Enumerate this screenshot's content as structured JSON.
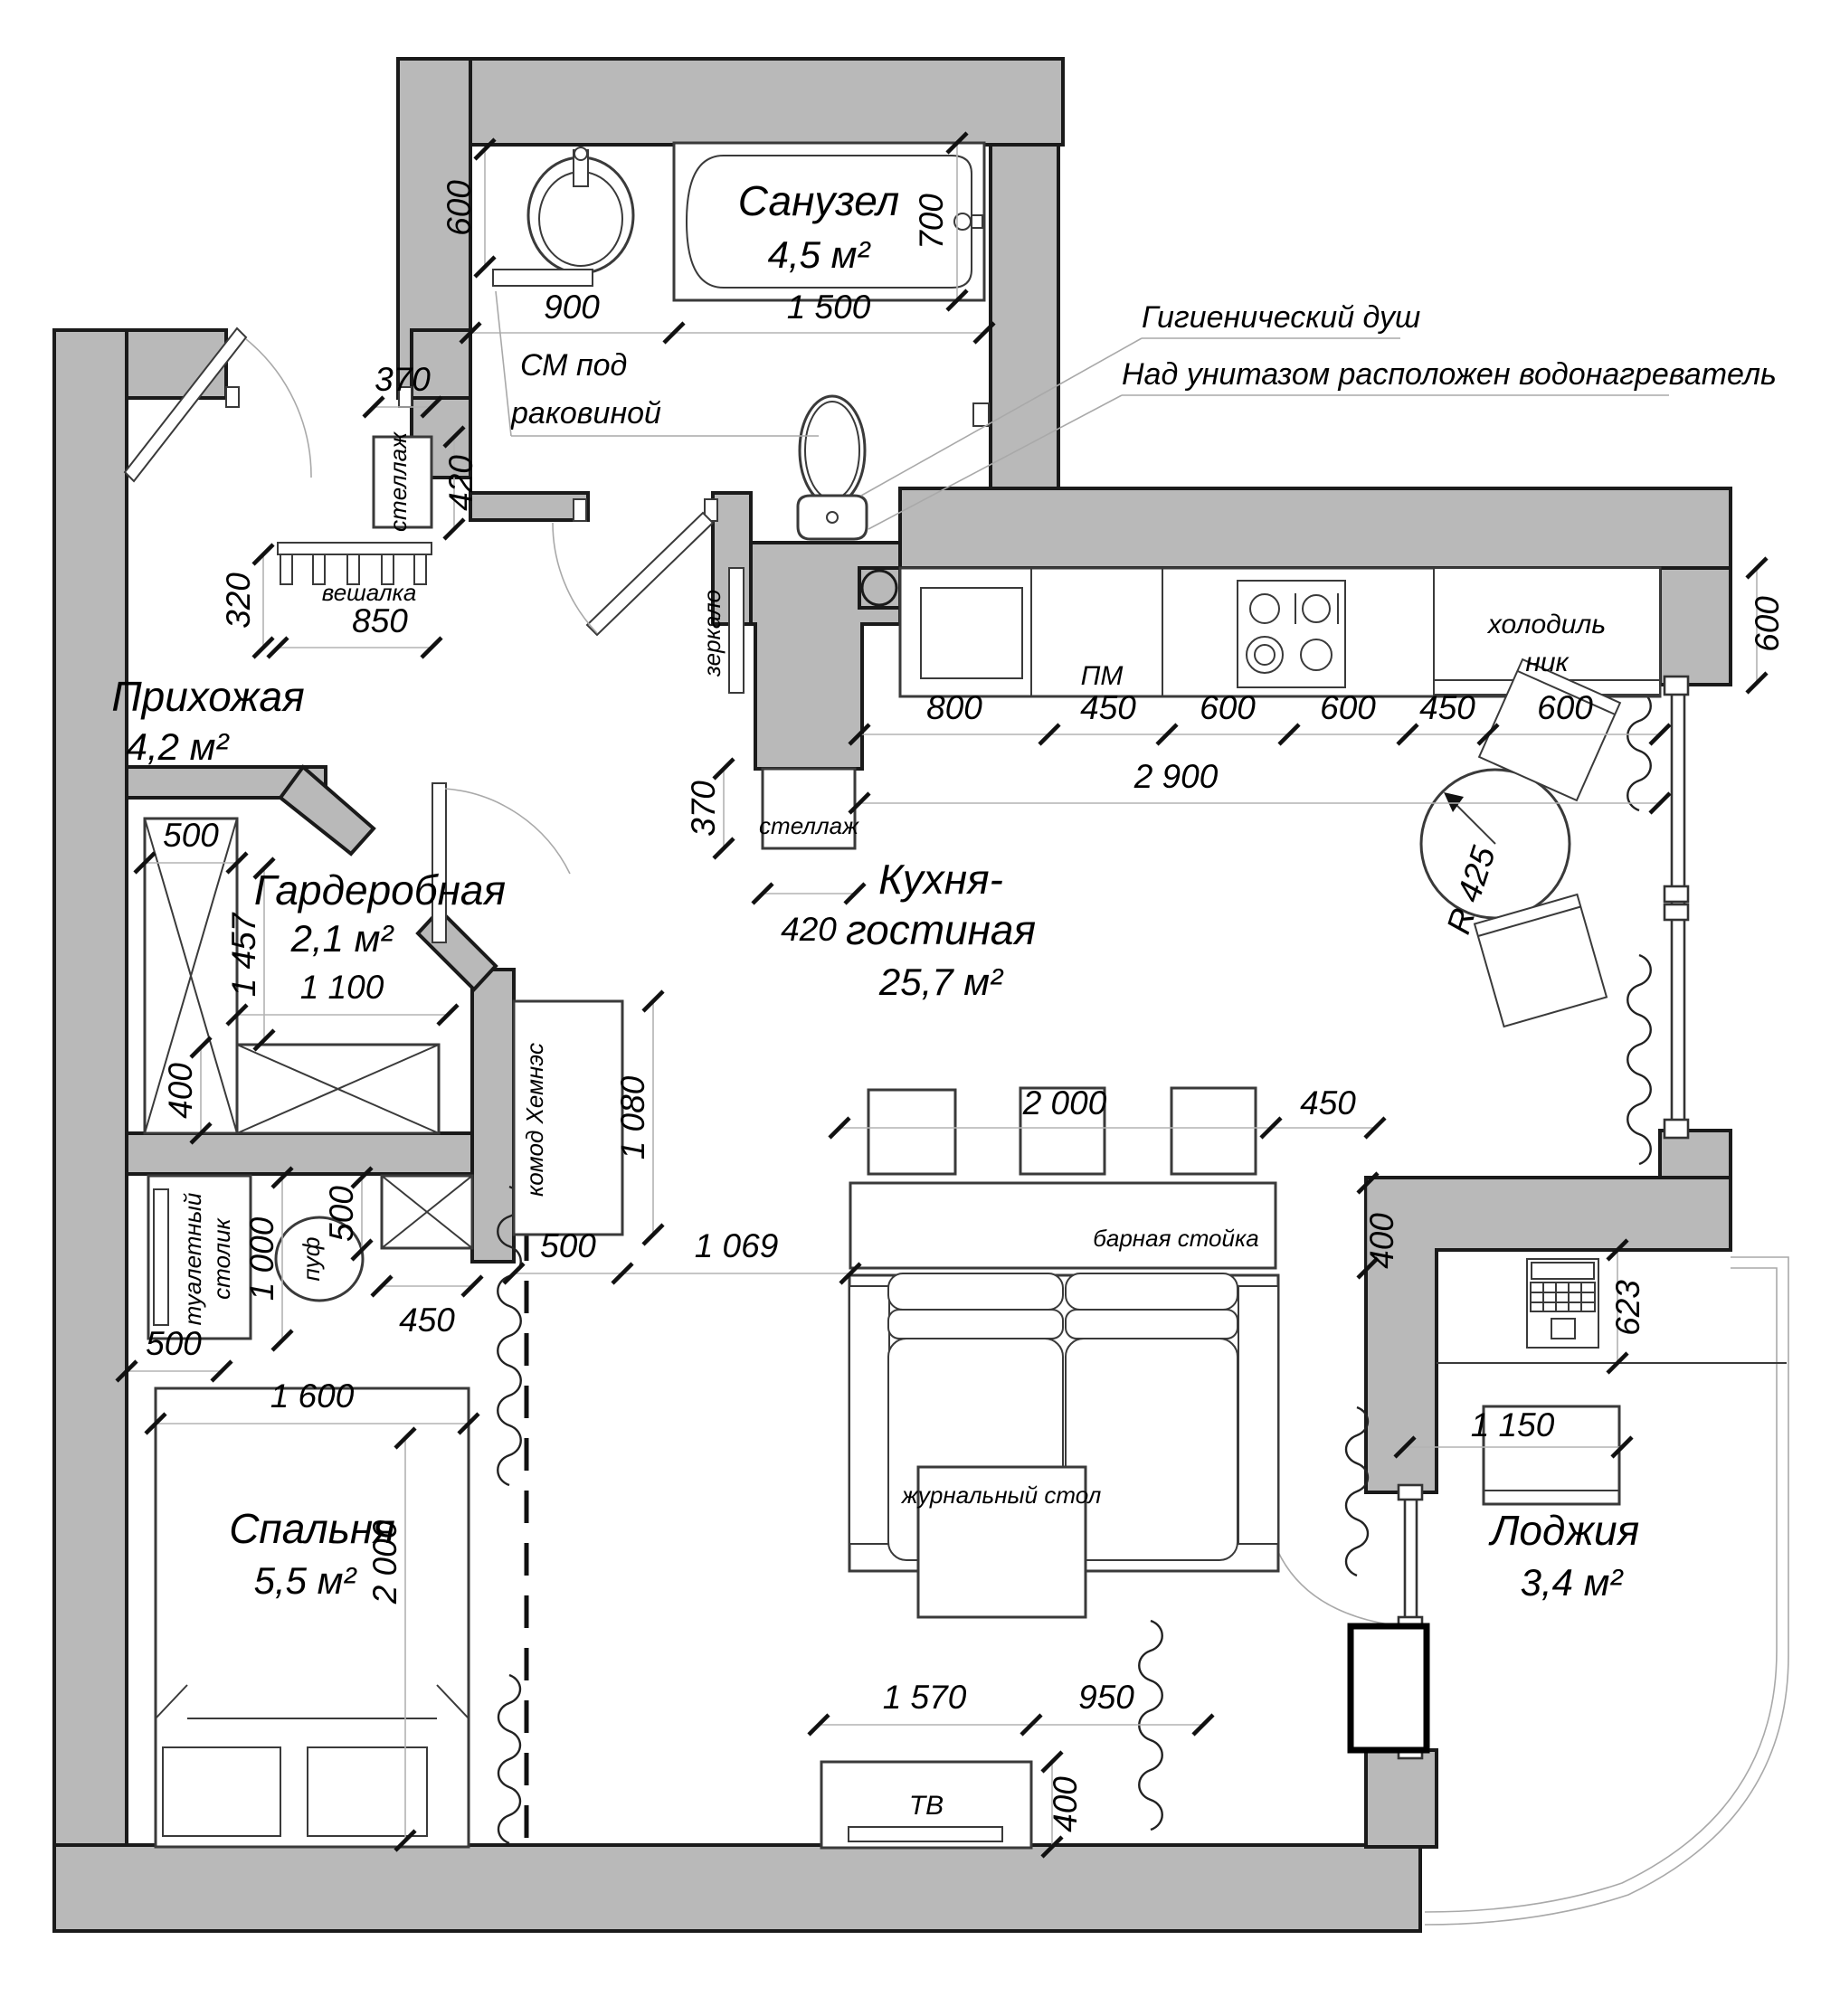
{
  "rooms": {
    "bathroom": {
      "name": "Санузел",
      "area": "4,5 м²"
    },
    "hallway": {
      "name": "Прихожая",
      "area": "4,2 м²"
    },
    "wardrobe": {
      "name": "Гардеробная",
      "area": "2,1 м²"
    },
    "kitchen": {
      "name_line1": "Кухня-",
      "name_line2": "гостиная",
      "area": "25,7 м²"
    },
    "bedroom": {
      "name": "Спальня",
      "area": "5,5 м²"
    },
    "loggia": {
      "name": "Лоджия",
      "area": "3,4 м²"
    }
  },
  "annotations": {
    "shower": "Гигиенический душ",
    "heater": "Над унитазом расположен водонагреватель",
    "washer_line1": "СМ под",
    "washer_line2": "раковиной"
  },
  "furniture": {
    "shelf_hall": "стеллаж",
    "shelf_kitchen": "стеллаж",
    "hanger": "вешалка",
    "mirror": "зеркало",
    "dishwasher": "ПМ",
    "fridge_line1": "холодиль",
    "fridge_line2": "ник",
    "dresser": "комод Хемнэс",
    "dressing_table_line1": "туалетный",
    "dressing_table_line2": "столик",
    "pouf": "пуф",
    "bar": "барная стойка",
    "coffee_table": "журнальный стол",
    "tv": "ТВ",
    "table_radius": "R 425"
  },
  "dims": {
    "bath_600": "600",
    "bath_900": "900",
    "bath_1500": "1 500",
    "bath_700": "700",
    "hall_370": "370",
    "hall_420": "420",
    "hall_320": "320",
    "hall_850": "850",
    "wr_500": "500",
    "wr_1457": "1 457",
    "wr_1100": "1 100",
    "wr_400": "400",
    "dr_1000": "1 000",
    "dr_500": "500",
    "dr_450": "450",
    "dr_500b": "500",
    "bed_1600": "1 600",
    "bed_2000": "2 000",
    "km_1080": "1 080",
    "km_500": "500",
    "km_1069": "1 069",
    "ksh_370": "370",
    "ksh_420": "420",
    "kc_800": "800",
    "kc_450a": "450",
    "kc_600a": "600",
    "kc_600b": "600",
    "kc_450b": "450",
    "kc_600c": "600",
    "kc_2900": "2 900",
    "bar_2000": "2 000",
    "bar_450": "450",
    "bar_400": "400",
    "wall_600": "600",
    "lg_623": "623",
    "lg_1150": "1 150",
    "tv_1570": "1 570",
    "tv_950": "950",
    "tv_400": "400"
  }
}
